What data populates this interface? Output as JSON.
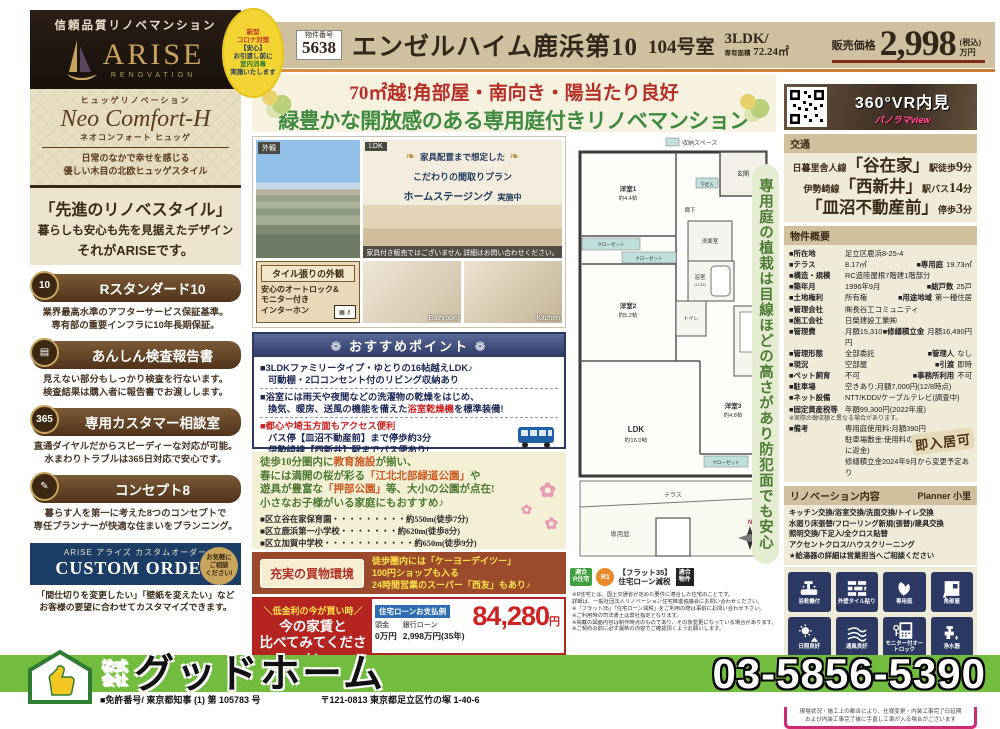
{
  "badge": {
    "l1": "新型",
    "l2": "コロナ対策",
    "l3": "【安心】",
    "l4": "お引渡し前に",
    "l5": "室内消毒",
    "l6": "実施いたします"
  },
  "header": {
    "no_label": "物件番号",
    "no": "5638",
    "title": "エンゼルハイム鹿浜第10",
    "room": "104号室",
    "type": "3LDK/",
    "area_label": "専有面積",
    "area": "72.24㎡",
    "price_label": "販売価格",
    "price": "2,998",
    "tax": "(税込)",
    "unit": "万円"
  },
  "sidebar": {
    "trust": "信頼品質リノベマンション",
    "brand": "ARISE",
    "brand_sub": "RENOVATION",
    "neo_ruby": "ヒュッゲリノベーション",
    "neo_name": "Neo Comfort-H",
    "neo_reading": "ネオコンフォート ヒュッゲ",
    "neo_desc1": "日常のなかで幸せを感じる",
    "neo_desc2": "優しい木目の北欧ヒュッゲスタイル",
    "tag1": "「先進のリノベスタイル」",
    "tag2": "暮らしも安心も先を見据えたデザイン",
    "tag3": "それがARISEです。",
    "features": [
      {
        "badge": "10",
        "title": "Rスタンダード10",
        "d1": "業界最高水準のアフターサービス保証基準。",
        "d2": "専有部の重要インフラに10年長期保証。"
      },
      {
        "badge": "▤",
        "title": "あんしん検査報告書",
        "d1": "見えない部分もしっかり検査を行ないます。",
        "d2": "検査結果は購入者に報告書でお渡しします。"
      },
      {
        "badge": "365",
        "title": "専用カスタマー相談室",
        "d1": "直通ダイヤルだからスピーディーな対応が可能。",
        "d2": "水まわりトラブルは365日対応で安心です。"
      },
      {
        "badge": "✎",
        "title": "コンセプト8",
        "d1": "暮らす人を第一に考えた8つのコンセプトで",
        "d2": "専任プランナーが快適な住まいをプランニング。"
      }
    ],
    "co_ruby": "アライズ カスタムオーダー",
    "co_brand": "ARISE",
    "co_name": "CUSTOM ORDER",
    "co_badge1": "お気軽に",
    "co_badge2": "ご相談",
    "co_badge3": "ください!",
    "co_d1": "「間仕切りを変更したい」「壁紙を変えたい」など",
    "co_d2": "お客様の要望に合わせてカスタマイズできます。"
  },
  "catch": {
    "line1": "70㎡越!角部屋・南向き・陽当たり良好",
    "line2": "緑豊かな開放感のある専用庭付きリノベマンション"
  },
  "photos": {
    "ext": "外観",
    "ldk": "LDK",
    "st1": "家具配置まで想定した",
    "st2": "こだわりの間取りプラン",
    "st3": "ホームステージング",
    "st4": "実施中",
    "caption": "家具付き販売ではございません 詳細はお問い合わせください。",
    "tile1": "タイル張りの外観",
    "tile2": "安心のオートロック&",
    "tile3": "モニター付き",
    "tile4": "インターホン",
    "bath": "Bathroom",
    "kitchen": "Kitchen"
  },
  "rec": {
    "title": "❁ おすすめポイント ❁",
    "i1h": "■3LDKファミリータイプ・ゆとりの16帖越えLDK♪",
    "i1b": "可動棚・2口コンセント付のリビング収納あり",
    "i2h": "■浴室には雨天や夜間などの洗濯物の乾燥をはじめ、",
    "i2pre": "換気、暖房、送風の機能を備えた",
    "i2red": "浴室乾燥機",
    "i2post": "を標準装備!",
    "i3h": "■都心や埼玉方面もアクセス便利",
    "i3b1": "バス停【皿沼不動産前】まで停歩約3分",
    "i3b2": "伊勢崎線【西新井】駅までバス便あり!"
  },
  "env": {
    "l1pre": "徒歩10分圏内に",
    "l1red": "教育施設",
    "l1post": "が揃い、",
    "l2pre": "春には満開の桜が彩る",
    "l2red": "「江北北部緑道公園」",
    "l2post": "や",
    "l3pre": "遊具が豊富な",
    "l3red": "「押部公園」",
    "l3post": "等、大小の公園が点在!",
    "l4": "小さなお子様がいる家庭にもおすすめ♪",
    "f1": "■区立谷在家保育園・・・・・・・・・約550m(徒歩7分)",
    "f2": "■区立鹿浜第一小学校・・・・・・・約620m(徒歩8分)",
    "f3": "■区立加賀中学校・・・・・・・・・・・約650m(徒歩9分)"
  },
  "shop": {
    "label": "充実の買物環境",
    "t1": "徒歩圏内には「ケーヨーデイツー」",
    "t2": "100円ショップも入る",
    "t3": "24時間営業のスーパー「西友」もあり♪"
  },
  "loan": {
    "c1": "＼低金利の今が買い時／",
    "c2": "今の家賃と",
    "c3": "比べてみてください",
    "thead": "住宅ローンお支払例",
    "k1": "頭金",
    "v1": "0万円",
    "k2": "銀行ローン",
    "v2": "2,998万円(35年)",
    "amount": "84,280",
    "unit": "円",
    "n1": "※35年返済・0.975%変動金利(2023年2月時点)りそな銀行1.7%優遇適用後に",
    "n2": "保証料の2%上乗せの金利で計算したものです。",
    "n3": "(条件により優遇金利とならない場合があります)"
  },
  "fp": {
    "legend": "収納スペース",
    "r1": "洋室1",
    "r1s": "約4.4帖",
    "r2": "洋室2",
    "r2s": "約5.2帖",
    "r3": "洋室3",
    "r3s": "約4.8帖",
    "ldk": "LDK",
    "ldks": "約16.0帖",
    "bath": "浴室",
    "bathsub": "(1216)",
    "wash": "洗面室",
    "wc": "トイレ",
    "hall": "廊下",
    "ent": "玄関",
    "shoe": "下足入",
    "cl1": "クローゼット",
    "cl2": "クローゼット",
    "cl3": "クローゼット",
    "terrace": "テラス",
    "garden": "専用庭",
    "north": "N",
    "b1a": "適合",
    "b1b": "R住宅",
    "b2": "R1",
    "b3a": "【フラット35】",
    "b3b": "住宅ローン減税",
    "b4a": "適合",
    "b4b": "物件",
    "n1": "※R住宅とは、国土交通省が定めた要件に適合した住宅のことです。",
    "n2": "詳細は、一般社団法人リノベーション住宅推進協議会にお問い合わせください。",
    "n3": "※「フラット35」「住宅ローン減税」をご利用の際は事前にお問い合わせ下さい。",
    "n4": "※ご利用時の司法書士は弊社指定となります。",
    "n5": "※掲載の図面内容は制作時点のものであり、その後変更になっている場合があります。",
    "n6": "※ご契約の前に必ず最新の内容でご確認頂くようお願いします。",
    "pill": "専用庭の植栽は目線ほどの高さがあり防犯面でも安心"
  },
  "vr": {
    "title": "360°VR内見",
    "sub": "パノラマview"
  },
  "access": {
    "title": "交通",
    "l1pre": "日暮里舎人線",
    "l1st": "「谷在家」",
    "l1post": "駅徒歩",
    "l1num": "9",
    "l1unit": "分",
    "l2pre": "伊勢崎線",
    "l2st": "「西新井」",
    "l2post": "駅バス",
    "l2num": "14",
    "l2unit": "分",
    "l3st": "「皿沼不動産前」",
    "l3post": "停歩",
    "l3num": "3",
    "l3unit": "分"
  },
  "outline": {
    "title": "物件概要",
    "stamp": "即入居可",
    "rows": [
      {
        "k": "■所在地",
        "v": "足立区鹿浜8-25-4"
      },
      {
        "k": "■テラス",
        "v": "8.17㎡",
        "k2": "■専用庭",
        "v2": "19.73㎡"
      },
      {
        "k": "■構造・規模",
        "v": "RC造陸屋根7階建1階部分"
      },
      {
        "k": "■築年月",
        "v": "1996年9月",
        "k2": "■総戸数",
        "v2": "25戸"
      },
      {
        "k": "■土地権利",
        "v": "所有権",
        "k2": "■用途地域",
        "v2": "第一種住居"
      },
      {
        "k": "■管理会社",
        "v": "㈱長谷工コミュニティ"
      },
      {
        "k": "■施工会社",
        "v": "日榮建設工業㈱"
      },
      {
        "k": "■管理費",
        "v": "月額15,310円",
        "k2": "■修繕積立金",
        "v2": "月額16,490円"
      },
      {
        "k": "■管理形態",
        "v": "全部委託",
        "k2": "■管理人",
        "v2": "なし"
      },
      {
        "k": "■現況",
        "v": "空部屋",
        "k2": "■引渡",
        "v2": "即時"
      },
      {
        "k": "■ペット飼育",
        "v": "不可",
        "k2": "■事務所利用",
        "v2": "不可"
      },
      {
        "k": "■駐車場",
        "v": "空きあり:月額7,000円(12/8時点)"
      },
      {
        "k": "■ネット設備",
        "v": "NTT/KDDI/ケーブルテレビ(調査中)"
      },
      {
        "k": "■固定資産税等",
        "v": "年額99,300円(2022年度)"
      },
      {
        "note": "※実際の徴収額と異なる場合があります。"
      },
      {
        "k": "■備考",
        "v": "専用庭使用料:月額390円"
      },
      {
        "v": "駐車場敷金:使用料の一ヶ月分(解約時に返金)"
      },
      {
        "v": "修繕積立金2024年9月から変更予定あり"
      }
    ]
  },
  "renov": {
    "title": "リノベーション内容",
    "planner": "Planner 小里",
    "l1": "キッチン交換/浴室交換/洗面交換/トイレ交換",
    "l2": "水廻り床張替/フローリング新規(張替)/建具交換",
    "l3": "照明交換/下足入/全クロス貼替",
    "l4": "アクセントクロス/ハウスクリーニング",
    "l5": "★給湯器の詳細は営業担当へご相談ください",
    "icons": [
      {
        "label": "浴乾機付"
      },
      {
        "label": "外壁タイル貼り"
      },
      {
        "label": "専用庭"
      },
      {
        "label": "角部屋"
      },
      {
        "label": "日照良好"
      },
      {
        "label": "通風良好"
      },
      {
        "label": "モニター付オートロック"
      },
      {
        "label": "浄水器"
      }
    ]
  },
  "pink": {
    "title": "★工事中物件も内見大歓迎★",
    "date_label": "【内装工事完了日】",
    "date": "2023年2月10日",
    "n1": "現場状況・施工上の都合により、仕様変更・内装工事完了日延期",
    "n2": "および内装工事完了後に手直し工事が入る場合がございます"
  },
  "footer": {
    "p1": "株式",
    "p2": "会社",
    "name": "グッドホーム",
    "phone": "03-5856-5390",
    "license": "■免許番号/ 東京都知事 (1) 第 105783 号",
    "address": "〒121-0813 東京都足立区竹の塚 1-40-6"
  },
  "colors": {
    "accent_red": "#b42421",
    "navy": "#2c3a63",
    "green": "#3e8a41",
    "footer_green": "#72bd3f",
    "magenta": "#cc2d72"
  }
}
